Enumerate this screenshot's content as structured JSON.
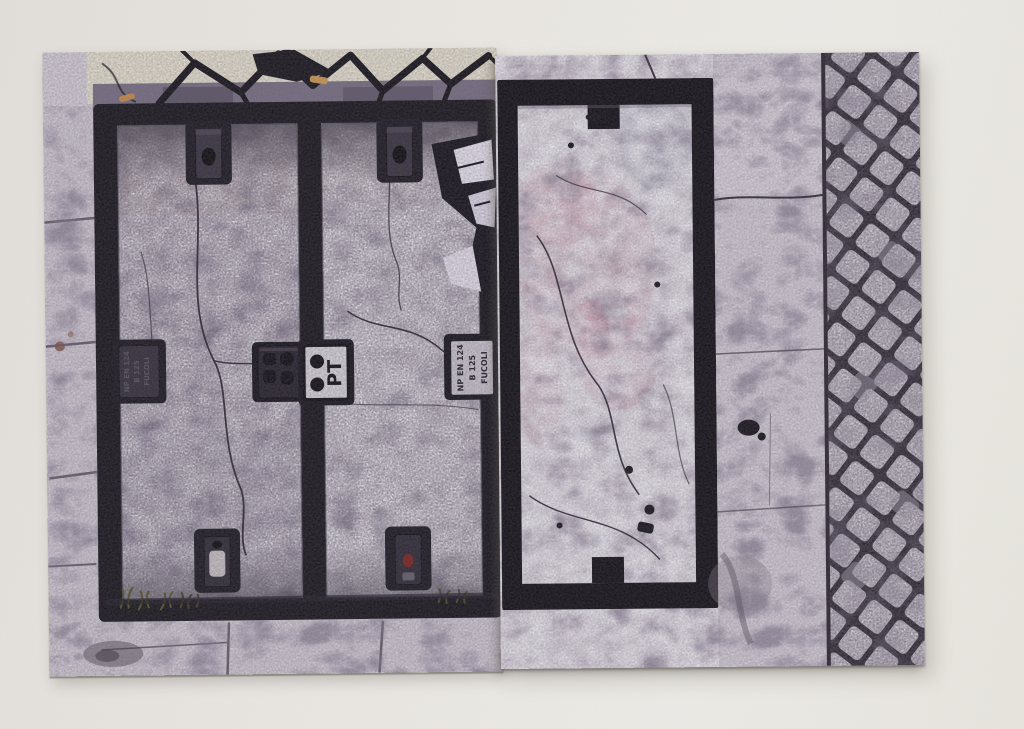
{
  "scene": {
    "description": "Two overlapping photographic prints of street pavement with utility access covers, lying on a pale grey surface",
    "surface_color": "#e9e6e1"
  },
  "left_print": {
    "subject": "Pair of rectangular telecom access covers framed in black cast iron, set in cracked pale lavender stone with a cream stone strip and tar seams at top",
    "frame_color": "#17151b",
    "stone_color": "#cfc9d3",
    "cream_stone_color": "#e6e1d0",
    "plates": {
      "pt_plate": {
        "text": "PT",
        "dots": 2,
        "plate_color": "#d8d4da"
      },
      "standard_plate": {
        "lines": [
          "NP EN 124",
          "B 125",
          "FUCOLI"
        ],
        "plate_color": "#c9c4ce"
      },
      "left_plate": {
        "lines": [
          "NP EN 124",
          "B 125",
          "FUCOLI"
        ],
        "legible": false
      },
      "clover_plate": {
        "symbols": 4
      }
    },
    "details": {
      "grass_color": "#55522e",
      "red_lock_dot": "#7d231d",
      "cigarette_butt_color": "#c98f4a"
    }
  },
  "right_print": {
    "subject": "Black rectangular outline of a utility cover in pale pink-tinted stone, with a smooth curb strip and a band of Portuguese cobblestones on the right",
    "outline_color": "#121016",
    "stone_color": "#d4ced7",
    "pink_tint": "#c795a3",
    "cobblestone": {
      "stone_color": "#d6d2da",
      "joint_color": "#232028"
    }
  }
}
